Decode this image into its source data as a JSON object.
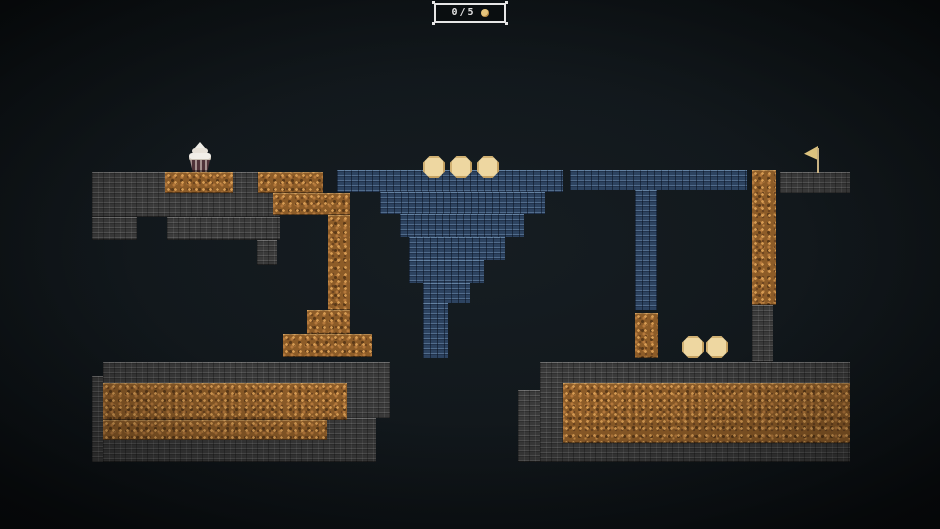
{
  "hud": {
    "counter": "0/5"
  },
  "colors": {
    "background": "#11171b",
    "stone": "#3a3a3a",
    "dirt": "#8d5c28",
    "water": "#2d4360",
    "coin": "#eed7a1",
    "flag": "#f0d48a",
    "player_frosting": "#f2efe9",
    "player_cup": "#503339",
    "hud_border": "#e6e6e6",
    "hud_text": "#e2e2e2"
  },
  "level": {
    "stone": [
      {
        "x": 92,
        "y": 172,
        "w": 188,
        "h": 45
      },
      {
        "x": 92,
        "y": 217,
        "w": 45,
        "h": 23
      },
      {
        "x": 167,
        "y": 217,
        "w": 113,
        "h": 23
      },
      {
        "x": 257,
        "y": 240,
        "w": 20,
        "h": 25
      },
      {
        "x": 103,
        "y": 362,
        "w": 287,
        "h": 56
      },
      {
        "x": 103,
        "y": 418,
        "w": 273,
        "h": 44
      },
      {
        "x": 92,
        "y": 376,
        "w": 11,
        "h": 86
      },
      {
        "x": 540,
        "y": 362,
        "w": 310,
        "h": 100
      },
      {
        "x": 518,
        "y": 390,
        "w": 22,
        "h": 72
      },
      {
        "x": 752,
        "y": 305,
        "w": 21,
        "h": 57
      },
      {
        "x": 780,
        "y": 172,
        "w": 70,
        "h": 21
      }
    ],
    "dirt": [
      {
        "x": 165,
        "y": 172,
        "w": 68,
        "h": 21
      },
      {
        "x": 258,
        "y": 172,
        "w": 65,
        "h": 21
      },
      {
        "x": 273,
        "y": 193,
        "w": 77,
        "h": 22
      },
      {
        "x": 328,
        "y": 215,
        "w": 22,
        "h": 95
      },
      {
        "x": 307,
        "y": 310,
        "w": 43,
        "h": 24
      },
      {
        "x": 283,
        "y": 334,
        "w": 89,
        "h": 23
      },
      {
        "x": 103,
        "y": 383,
        "w": 244,
        "h": 37
      },
      {
        "x": 103,
        "y": 420,
        "w": 224,
        "h": 20
      },
      {
        "x": 563,
        "y": 383,
        "w": 287,
        "h": 60
      },
      {
        "x": 752,
        "y": 170,
        "w": 24,
        "h": 135
      },
      {
        "x": 635,
        "y": 313,
        "w": 23,
        "h": 45
      }
    ],
    "water": [
      {
        "x": 337,
        "y": 170,
        "w": 226,
        "h": 22
      },
      {
        "x": 380,
        "y": 192,
        "w": 165,
        "h": 22
      },
      {
        "x": 400,
        "y": 214,
        "w": 124,
        "h": 23
      },
      {
        "x": 409,
        "y": 237,
        "w": 96,
        "h": 23
      },
      {
        "x": 409,
        "y": 260,
        "w": 75,
        "h": 23
      },
      {
        "x": 423,
        "y": 283,
        "w": 47,
        "h": 20
      },
      {
        "x": 423,
        "y": 303,
        "w": 25,
        "h": 55
      },
      {
        "x": 570,
        "y": 170,
        "w": 177,
        "h": 20
      },
      {
        "x": 635,
        "y": 190,
        "w": 22,
        "h": 120
      }
    ]
  },
  "entities": {
    "player": {
      "x": 187,
      "y": 142,
      "w": 26,
      "h": 30
    },
    "flag": {
      "x": 801,
      "y": 146,
      "w": 22,
      "h": 27
    },
    "coin_diameter": 22,
    "coins": [
      {
        "cx": 434,
        "cy": 167
      },
      {
        "cx": 461,
        "cy": 167
      },
      {
        "cx": 488,
        "cy": 167
      },
      {
        "cx": 693,
        "cy": 347
      },
      {
        "cx": 717,
        "cy": 347
      }
    ]
  }
}
